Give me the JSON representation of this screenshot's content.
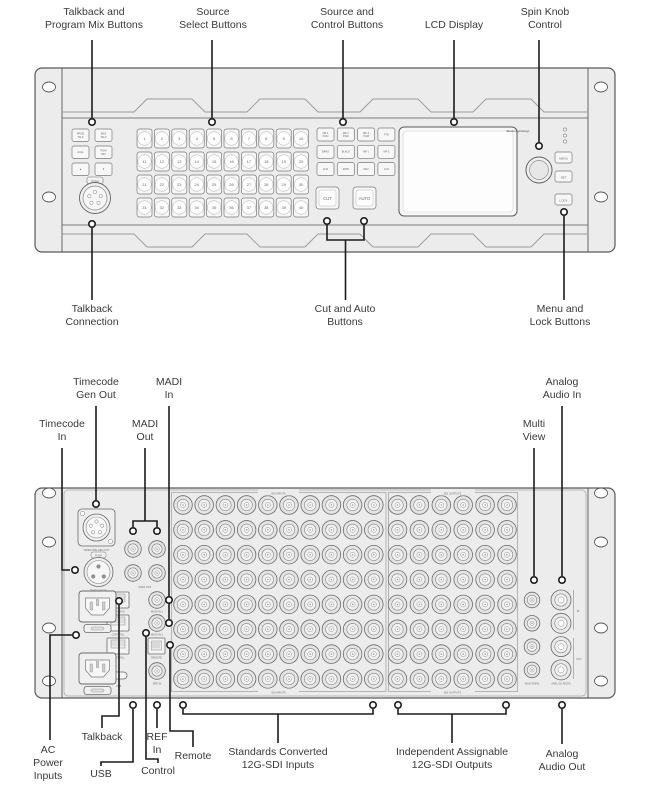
{
  "front_panel": {
    "callouts_top": [
      "Talkback and\nProgram Mix Buttons",
      "Source\nSelect Buttons",
      "Source and\nControl Buttons",
      "LCD Display",
      "Spin Knob\nControl"
    ],
    "callouts_bottom": [
      "Talkback\nConnection",
      "Cut and Auto\nButtons",
      "Menu and\nLock Buttons"
    ],
    "talkback_buttons": [
      "PROD\nTALK",
      "ENG\nTALK",
      "CALL",
      "PGM\nMIX",
      "▲",
      "▼"
    ],
    "push_label": "PUSH",
    "source_buttons": [
      "1",
      "2",
      "3",
      "4",
      "5",
      "6",
      "7",
      "8",
      "9",
      "10",
      "11",
      "12",
      "13",
      "14",
      "15",
      "16",
      "17",
      "18",
      "19",
      "20",
      "21",
      "22",
      "23",
      "24",
      "25",
      "26",
      "27",
      "28",
      "29",
      "30",
      "31",
      "32",
      "33",
      "34",
      "35",
      "36",
      "37",
      "38",
      "39",
      "40"
    ],
    "control_buttons": [
      "ME 1\nPGM",
      "ME 2\nPGM",
      "ME 3\nPGM",
      "FTB",
      "BARS",
      "BLACK",
      "MP 1",
      "MP 2",
      "AUX",
      "MVW",
      "MAC",
      "CLN"
    ],
    "cut_label": "CUT",
    "auto_label": "AUTO",
    "brand": "Blackmagicdesign",
    "menu_buttons": [
      "MENU",
      "SET",
      "LOCK"
    ]
  },
  "rear_panel": {
    "callouts_top": [
      "Timecode\nGen Out",
      "Timecode\nIn",
      "MADI\nOut",
      "MADI\nIn",
      "Multi\nView",
      "Analog\nAudio In"
    ],
    "callouts_bottom": [
      "AC\nPower\nInputs",
      "Talkback",
      "USB",
      "Control",
      "REF\nIn",
      "Remote",
      "Standards Converted\n12G-SDI Inputs",
      "Independent Assignable\n12G-SDI Outputs",
      "Analog\nAudio Out"
    ],
    "port_labels": {
      "timecode_gen_out": "TIMECODE GEN OUT",
      "timecode_in": "TIMECODE IN",
      "push": "PUSH",
      "madi_out": "MADI OUT",
      "madi_in_1": "MADI IN 1",
      "madi_in_2": "MADI IN 2",
      "talkback": "TALKBACK",
      "control_a": "CONTROL",
      "control_b": "CONTROL",
      "remote": "REMOTE",
      "usb": "USB",
      "ref_in": "REF IN",
      "multiview": "MULTIVIEW",
      "analog_audio": "ANALOG AUDIO",
      "audio_in_group": "IN",
      "audio_out_group": "OUT"
    },
    "sdi_inputs": {
      "label": "SDI INPUTS",
      "rows": 8,
      "cols": 10
    },
    "sdi_outputs": {
      "label": "SDI OUTPUTS",
      "rows": 8,
      "cols": 6
    },
    "madi_out_count": 4,
    "madi_in_count": 2,
    "multiview_count": 4,
    "audio_jack_count": 4
  },
  "colors": {
    "panel_fill": "#ececec",
    "outline": "#5a5a5a",
    "callout_line": "#1c1c1c",
    "label_text": "#3a3a3a",
    "button_fill": "#f7f7f7"
  }
}
